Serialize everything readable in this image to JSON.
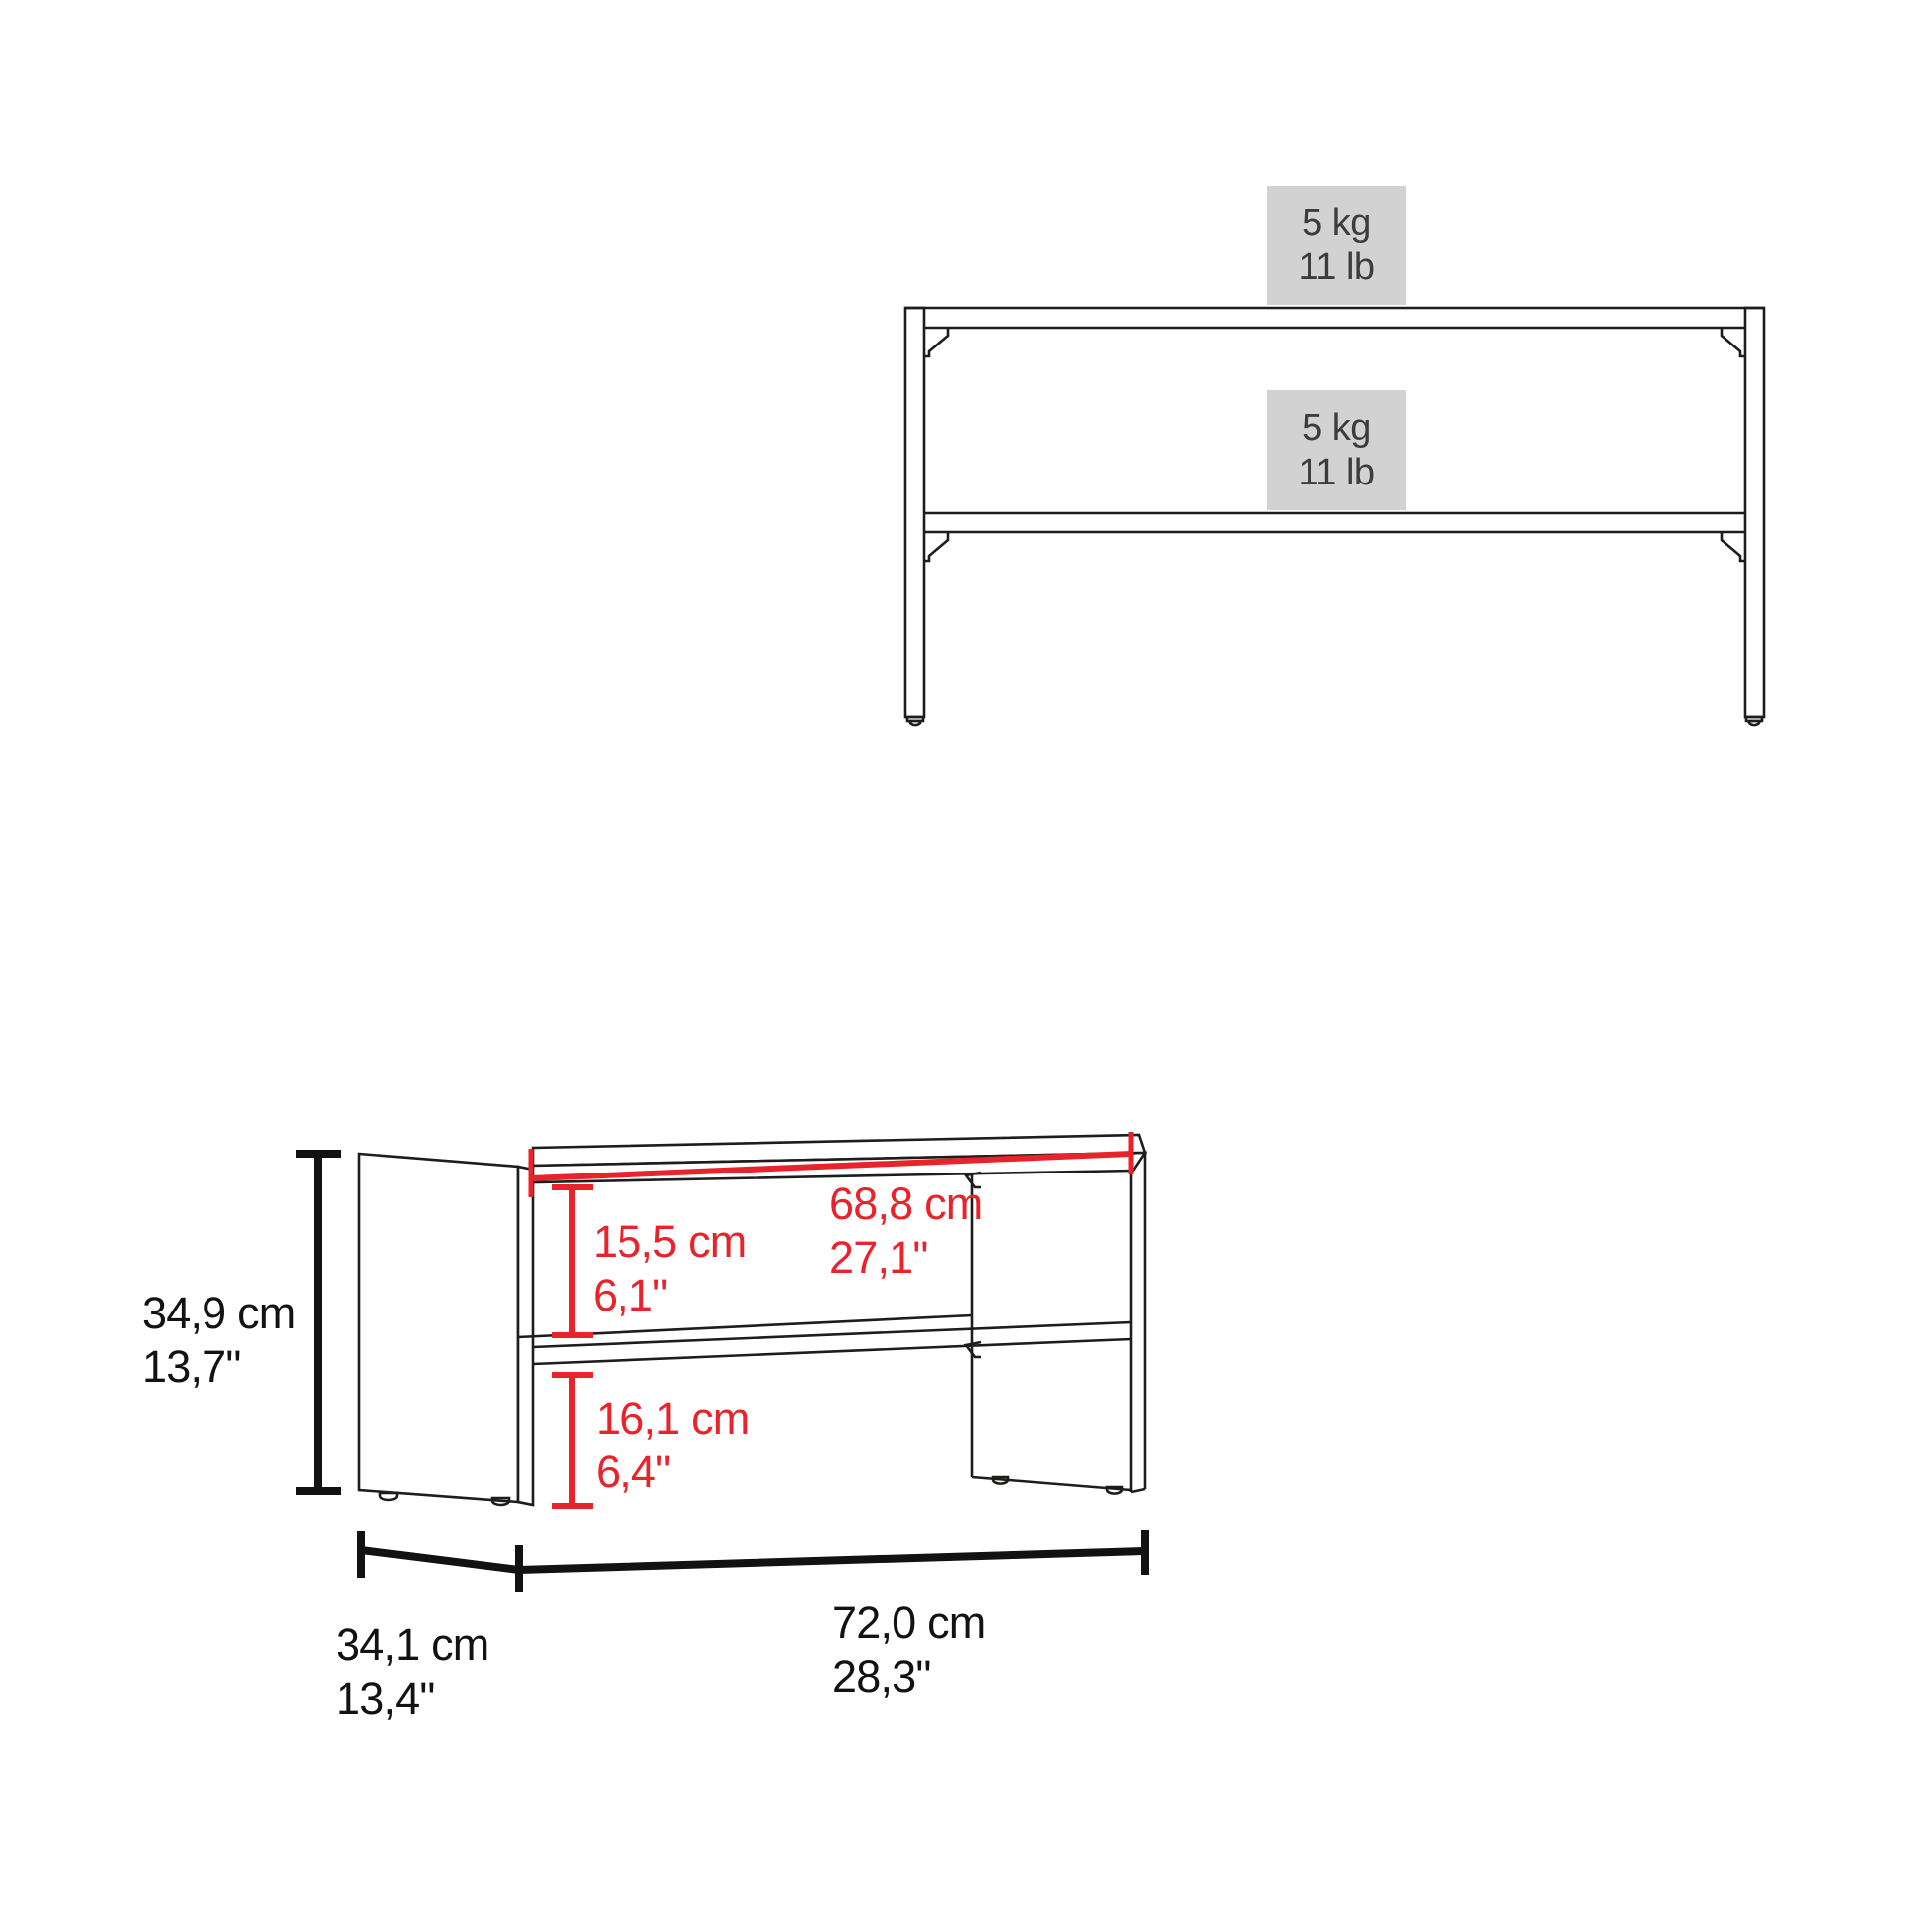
{
  "front_view": {
    "loads": [
      {
        "location": "top-surface",
        "kg": "5 kg",
        "lb": "11 lb"
      },
      {
        "location": "shelf",
        "kg": "5 kg",
        "lb": "11 lb"
      }
    ]
  },
  "dimension_view": {
    "height": {
      "cm": "34,9 cm",
      "inch": "13,7\""
    },
    "inner_width": {
      "cm": "68,8 cm",
      "inch": "27,1\""
    },
    "upper_clearance": {
      "cm": "15,5 cm",
      "inch": "6,1\""
    },
    "lower_clearance": {
      "cm": "16,1 cm",
      "inch": "6,4\""
    },
    "depth": {
      "cm": "34,1 cm",
      "inch": "13,4\""
    },
    "width": {
      "cm": "72,0 cm",
      "inch": "28,3\""
    }
  },
  "colors": {
    "dimension_red": "#e8232b",
    "line_black": "#1d1d1b",
    "load_box_bg": "#d2d2d2",
    "load_text": "#3c3c3c"
  }
}
